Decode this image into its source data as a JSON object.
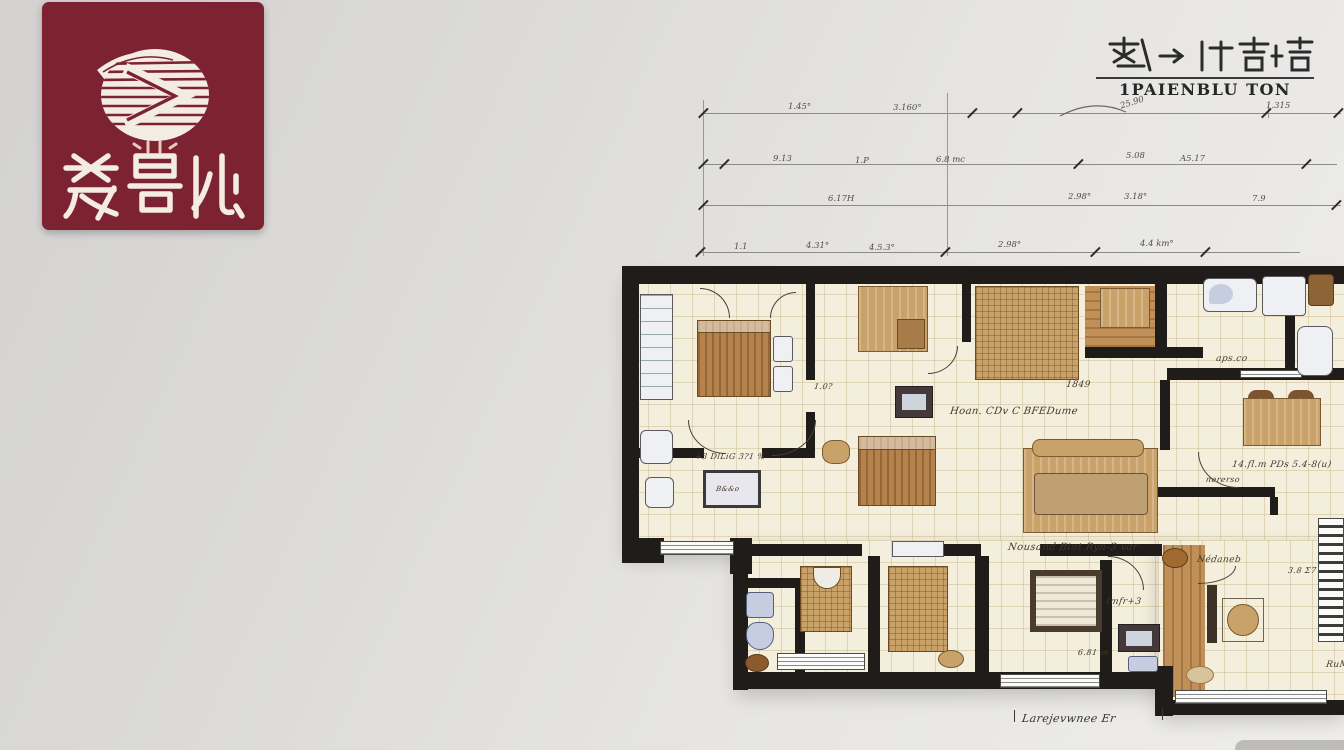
{
  "page": {
    "background_top_right": "#eeedeb",
    "background_bottom_left": "#d3d2d0"
  },
  "logo_badge": {
    "color": "#7c2231",
    "emblem": "white-ellipse-striped-chevron-logo",
    "characters": "荎曼仳"
  },
  "header": {
    "cjk_title": "栽→ 仠吉堵",
    "latin_title": "1PAIENBLU TON"
  },
  "dimensions": {
    "row1": [
      "1.45°",
      "3.160°",
      "25.90",
      "1.315"
    ],
    "row2": [
      "9.13",
      "1.P",
      "6.8 mc",
      "5.08",
      "A5.17"
    ],
    "row3": [
      "6.17H",
      "2.98°",
      "3.18°",
      "7.9"
    ],
    "row4": [
      "1.1",
      "4.31°",
      "4.5.3°",
      "2.98°",
      "4.4 km°"
    ]
  },
  "plan_labels": {
    "left_room": "+3 DlLiG 3?1 %",
    "table_text": "B&&o",
    "door_dim": "1.0?",
    "center_room": "Hoan. CDv C BFEDume",
    "wardrobe_dim": "1849",
    "bath_dim": "aps.co",
    "right_room_line1": "14.fl.m PDs 5.4-8(u)",
    "right_room_line2": "nererso",
    "bottom_center_room": "Nousand Bint Ryn-3 var",
    "closet_note": "Imfr+3",
    "tv_dim": "6.81 m",
    "corridor": "Nédaneb",
    "right_area": "3.8 Σ7",
    "right_edge": "RuM",
    "bottom_annotation": "Larejevwnee Er"
  }
}
